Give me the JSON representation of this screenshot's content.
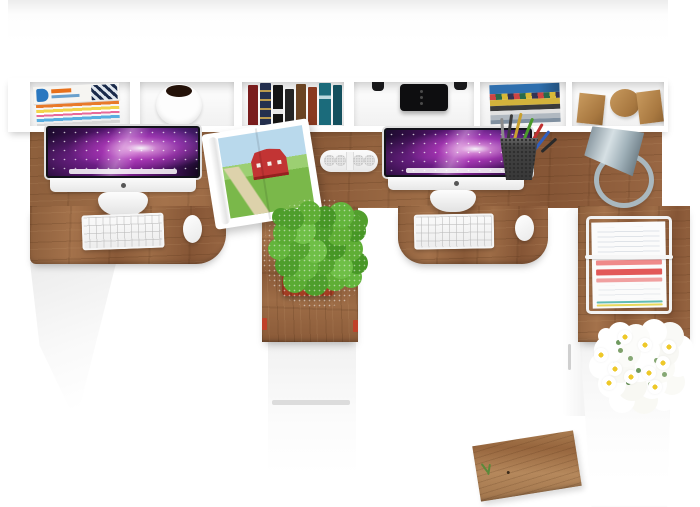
{
  "meta": {
    "type": "3d-render-top-view",
    "description": "Top view of a white double workstation desk with oak worktops, wall shelf unit, two iMac computers, plants and office accessories",
    "background_color": "#ffffff"
  },
  "palette": {
    "wood": "#9a6b45",
    "wood_light": "#b08256",
    "white_furniture": "#f6f6f6",
    "screen_purple": "#7a1f8a",
    "screen_pink": "#e87bd8",
    "screen_dark": "#1c0b2e",
    "plant_green": "#55a32f",
    "pot_red": "#bf4a2e",
    "lamp_silver": "#a9b8bf",
    "flower_white": "#ffffff",
    "flower_center_yellow": "#eec829",
    "paper_highlight_red": "#e25858",
    "book_red": "#7a1d1d",
    "book_navy": "#24304e",
    "book_teal": "#1b6b7b",
    "mug_interior": "#241209",
    "magazine_blue": "#2b78c0"
  },
  "shelf": {
    "compartments": [
      {
        "name": "magazines-stack"
      },
      {
        "name": "white-mug"
      },
      {
        "name": "vertical-book-row"
      },
      {
        "name": "black-headphones"
      },
      {
        "name": "stacked-books"
      },
      {
        "name": "wooden-bookends"
      }
    ]
  },
  "desk": {
    "sections": [
      {
        "name": "left-workstation",
        "items": [
          "imac",
          "keyboard",
          "mouse"
        ]
      },
      {
        "name": "center-pedestal",
        "items": [
          "potted-plant",
          "drawer-cabinet"
        ]
      },
      {
        "name": "right-workstation",
        "items": [
          "imac",
          "keyboard",
          "mouse",
          "pencil-cup",
          "desk-lamp"
        ]
      },
      {
        "name": "right-return",
        "items": [
          "wire-document-tray",
          "white-flowers",
          "side-cabinet"
        ]
      }
    ],
    "loose_items": [
      "open-picture-book",
      "pill-speaker",
      "wood-bench-plank"
    ]
  },
  "labels": {
    "scene": "Office workspace seen from above"
  }
}
